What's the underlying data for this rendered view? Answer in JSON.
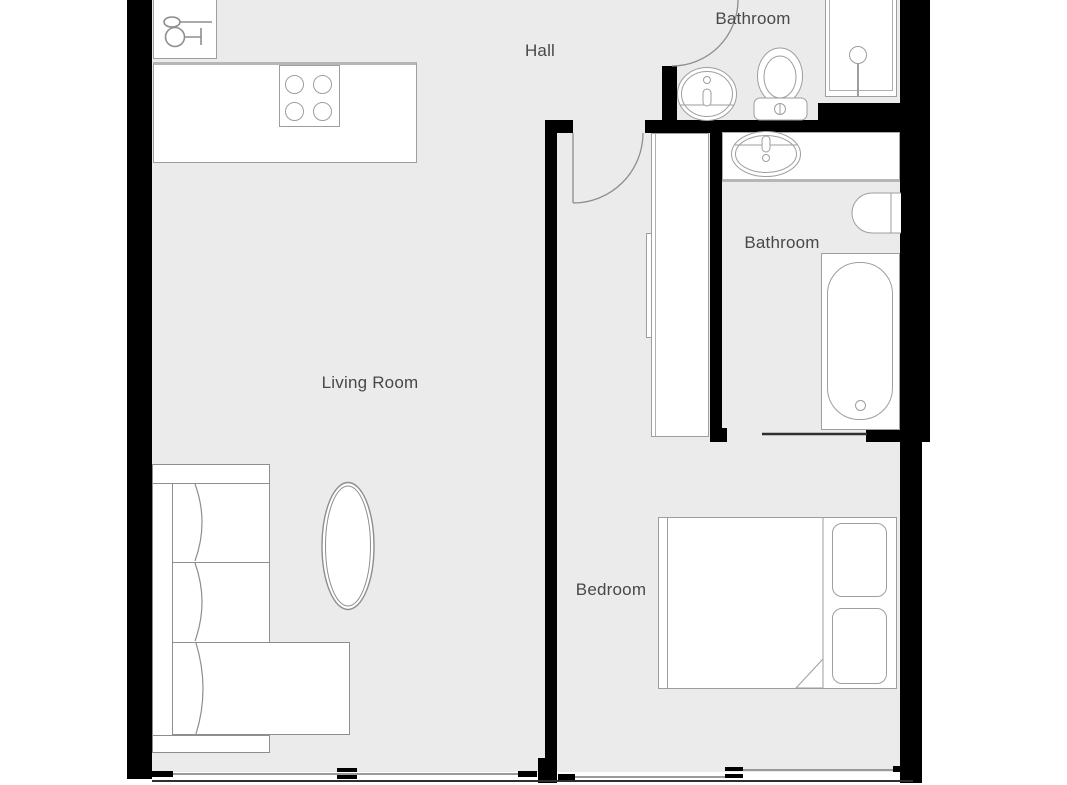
{
  "rooms": {
    "hall": {
      "label": "Hall"
    },
    "bathroom_top": {
      "label": "Bathroom"
    },
    "bathroom_side": {
      "label": "Bathroom"
    },
    "living_room": {
      "label": "Living Room"
    },
    "bedroom": {
      "label": "Bedroom"
    }
  },
  "fixtures": {
    "kitchen": [
      "dishwasher",
      "counter",
      "cooktop-4-burner"
    ],
    "bathroom_top": [
      "shower",
      "oval-sink",
      "toilet"
    ],
    "bathroom_side": [
      "vanity-counter",
      "oval-sink",
      "wall-hung-toilet",
      "bathtub"
    ],
    "bedroom": [
      "wardrobe",
      "double-bed",
      "pillow",
      "pillow",
      "folded-blanket"
    ],
    "living_room": [
      "sectional-sofa",
      "oval-coffee-table"
    ],
    "doors": [
      "bathroom-top-swing-door",
      "bedroom-swing-door",
      "bathroom-side-sliding-door"
    ],
    "windows": [
      "living-room-window",
      "bedroom-window"
    ]
  },
  "icons": {
    "dishwasher": "spoon-and-wine-glass-icon",
    "shower": "shower-head-icon"
  },
  "colors": {
    "floor": "#ebebeb",
    "wall": "#000000",
    "fixture_fill": "#ffffff",
    "fixture_outline": "#9e9e9e",
    "furniture_outline": "#8e8e8e",
    "window_line": "#9a9a9a",
    "base_line": "#2f2f2f",
    "label_text": "#46484c",
    "outside": "#ffffff"
  }
}
